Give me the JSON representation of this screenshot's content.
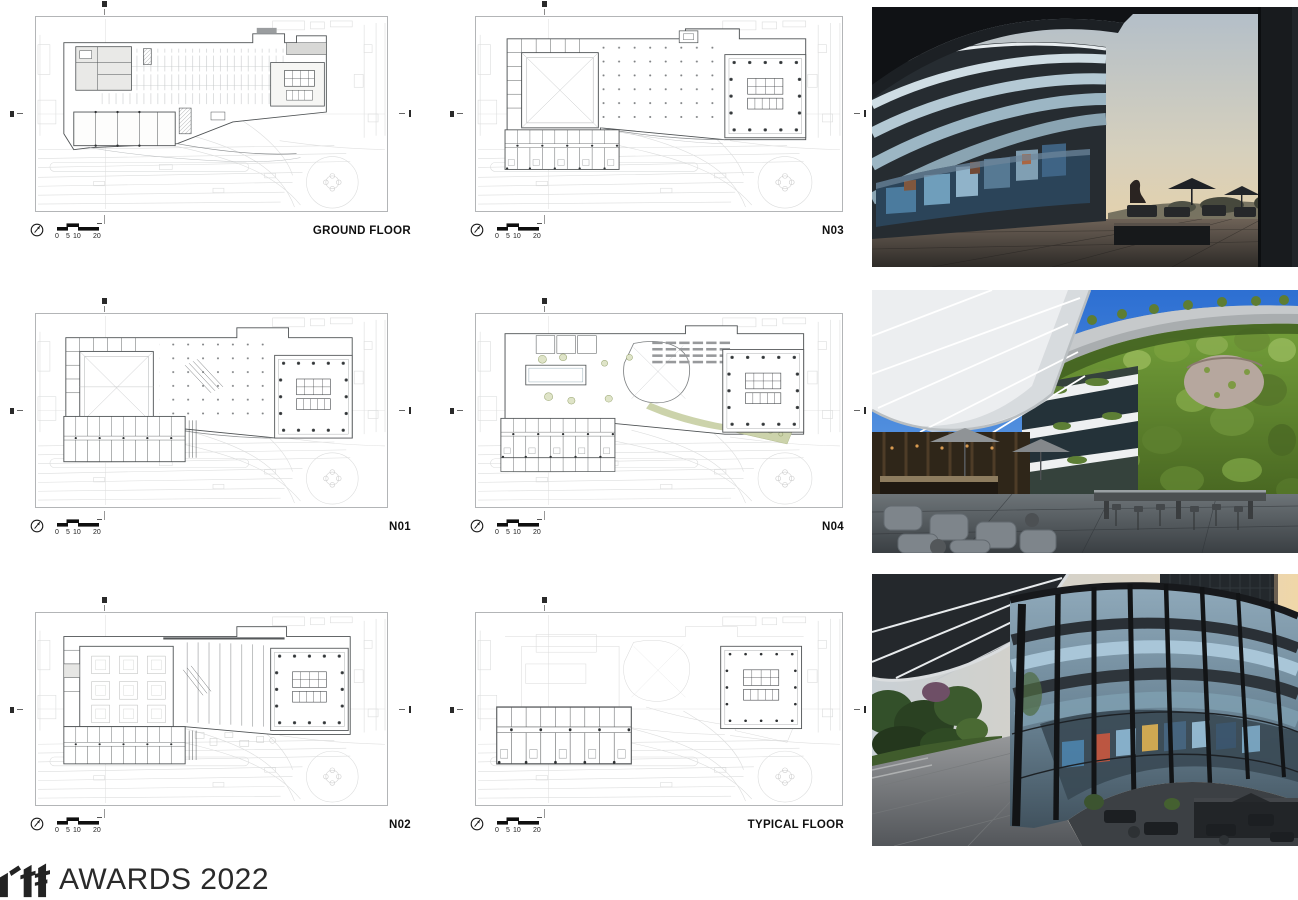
{
  "plans": [
    {
      "id": "ground-floor",
      "label": "GROUND FLOOR"
    },
    {
      "id": "n03",
      "label": "N03"
    },
    {
      "id": "n01",
      "label": "N01"
    },
    {
      "id": "n04",
      "label": "N04"
    },
    {
      "id": "n02",
      "label": "N02"
    },
    {
      "id": "typical-floor",
      "label": "TYPICAL FLOOR"
    }
  ],
  "scale_bar": {
    "ticks": [
      "0",
      "5",
      "10",
      "20"
    ]
  },
  "photos": [
    {
      "id": "photo-plaza-dusk",
      "name": "curved-glass-facade-over-entry-plaza-at-dusk"
    },
    {
      "id": "photo-green-wall-terrace",
      "name": "courtyard-terrace-with-living-green-wall-and-canopy"
    },
    {
      "id": "photo-curtain-wall-sunset",
      "name": "curved-curtain-wall-with-reflections-at-sunset"
    }
  ],
  "footer": {
    "logo_text": "rtf",
    "award_text": "AWARDS 2022"
  },
  "colors": {
    "plan_line": "#4e5254",
    "context_line": "#dcdddd",
    "landscape_green": "#ccd3ab",
    "label_color": "#101010",
    "logo_color": "#232323"
  }
}
